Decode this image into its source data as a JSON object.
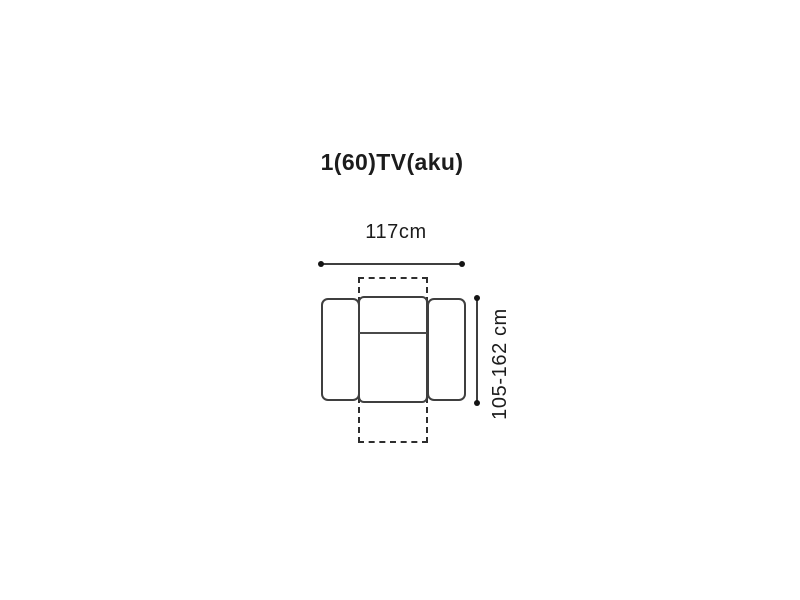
{
  "diagram": {
    "title": "1(60)TV(aku)",
    "type": "furniture-top-view-dimension-diagram",
    "item": "recliner-armchair",
    "width_dimension": {
      "label": "117cm",
      "value_cm": 117,
      "orientation": "horizontal"
    },
    "height_dimension": {
      "label": "105-162 cm",
      "value_min_cm": 105,
      "value_max_cm": 162,
      "orientation": "vertical-rotated",
      "note": "range covers upright to fully reclined footprint shown by dashed outline"
    },
    "colors": {
      "background": "#ffffff",
      "line": "#3f3f3f",
      "text": "#1c1c1c",
      "dot": "#141414"
    }
  }
}
